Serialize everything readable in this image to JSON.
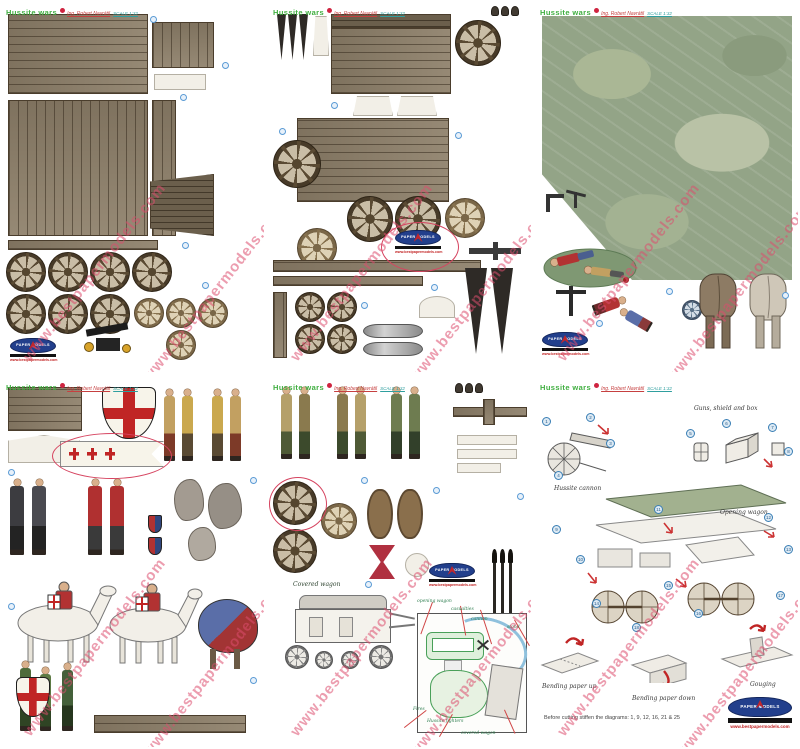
{
  "watermark": "www.bestpapermodels.com",
  "header": {
    "title": "Hussite wars",
    "author": "Ing. Robert Navrátil",
    "scale": "SCALE 1:32"
  },
  "logo": {
    "name": "PAPER MODELS",
    "url": "www.bestpapermodels.com"
  },
  "sheet5": {
    "covered_wagon_caption": "Covered wagon",
    "plan_labels": {
      "opening_wagon": "opening wagon",
      "casualties": "casualties",
      "cannon": "cannon",
      "stand": "stand",
      "fires": "Fires",
      "hussite_fighters": "Hussite fighters",
      "covered_wagon": "covered wagon"
    }
  },
  "sheet6": {
    "guns_shield_box": "Guns, shield and box",
    "hussite_cannon": "Hussite cannon",
    "opening_wagon": "Opening wagon",
    "bending_up": "Bending paper up",
    "bending_down": "Bending paper down",
    "gouging": "Gouging",
    "footer": "Before cutting stiffen the diagrams: 1, 9, 12, 16, 21 & 25",
    "callouts": [
      "1",
      "2",
      "3",
      "4",
      "5",
      "6",
      "7",
      "8",
      "9",
      "10",
      "11",
      "12",
      "13",
      "14",
      "15",
      "16",
      "17",
      "18"
    ]
  }
}
